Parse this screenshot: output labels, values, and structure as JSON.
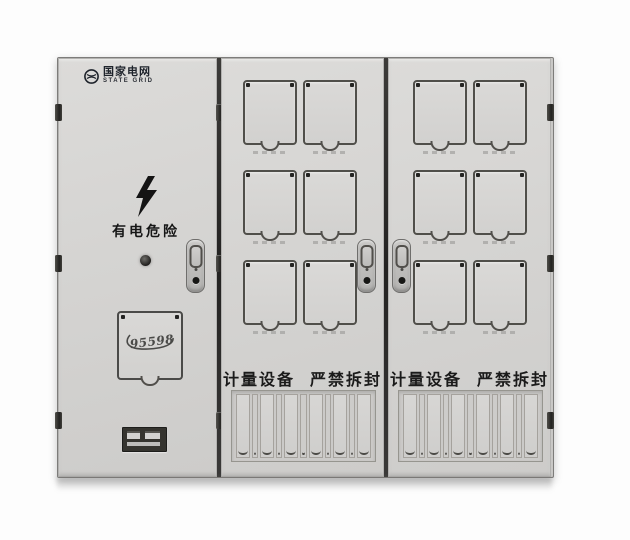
{
  "brand": {
    "name_cn": "国家电网",
    "name_en": "STATE GRID"
  },
  "left_door": {
    "danger_label": "有电危险",
    "service_hotline": "95598"
  },
  "meter_door": {
    "seal_warning_a": "计量设备",
    "seal_warning_b": "严禁拆封"
  },
  "structure": {
    "doors": 3,
    "meter_windows_per_door": 6,
    "meter_window_rows": 3,
    "meter_window_cols": 2,
    "cable_slots_per_door": 6
  },
  "icons": {
    "emblem": "state-grid-globe-emblem",
    "bolt": "lightning-bolt",
    "lock": "oval-recessed-door-lock",
    "keyhole": "round-keyhole"
  },
  "colors": {
    "background": "#ffffff",
    "cabinet_body": "#d4d3d1",
    "door_outline": "#7d7c7a",
    "divider_dark": "#2a2927",
    "window_outline": "#504f4a",
    "text_dark": "#1b1b1b",
    "logo_dark": "#1e232b"
  }
}
